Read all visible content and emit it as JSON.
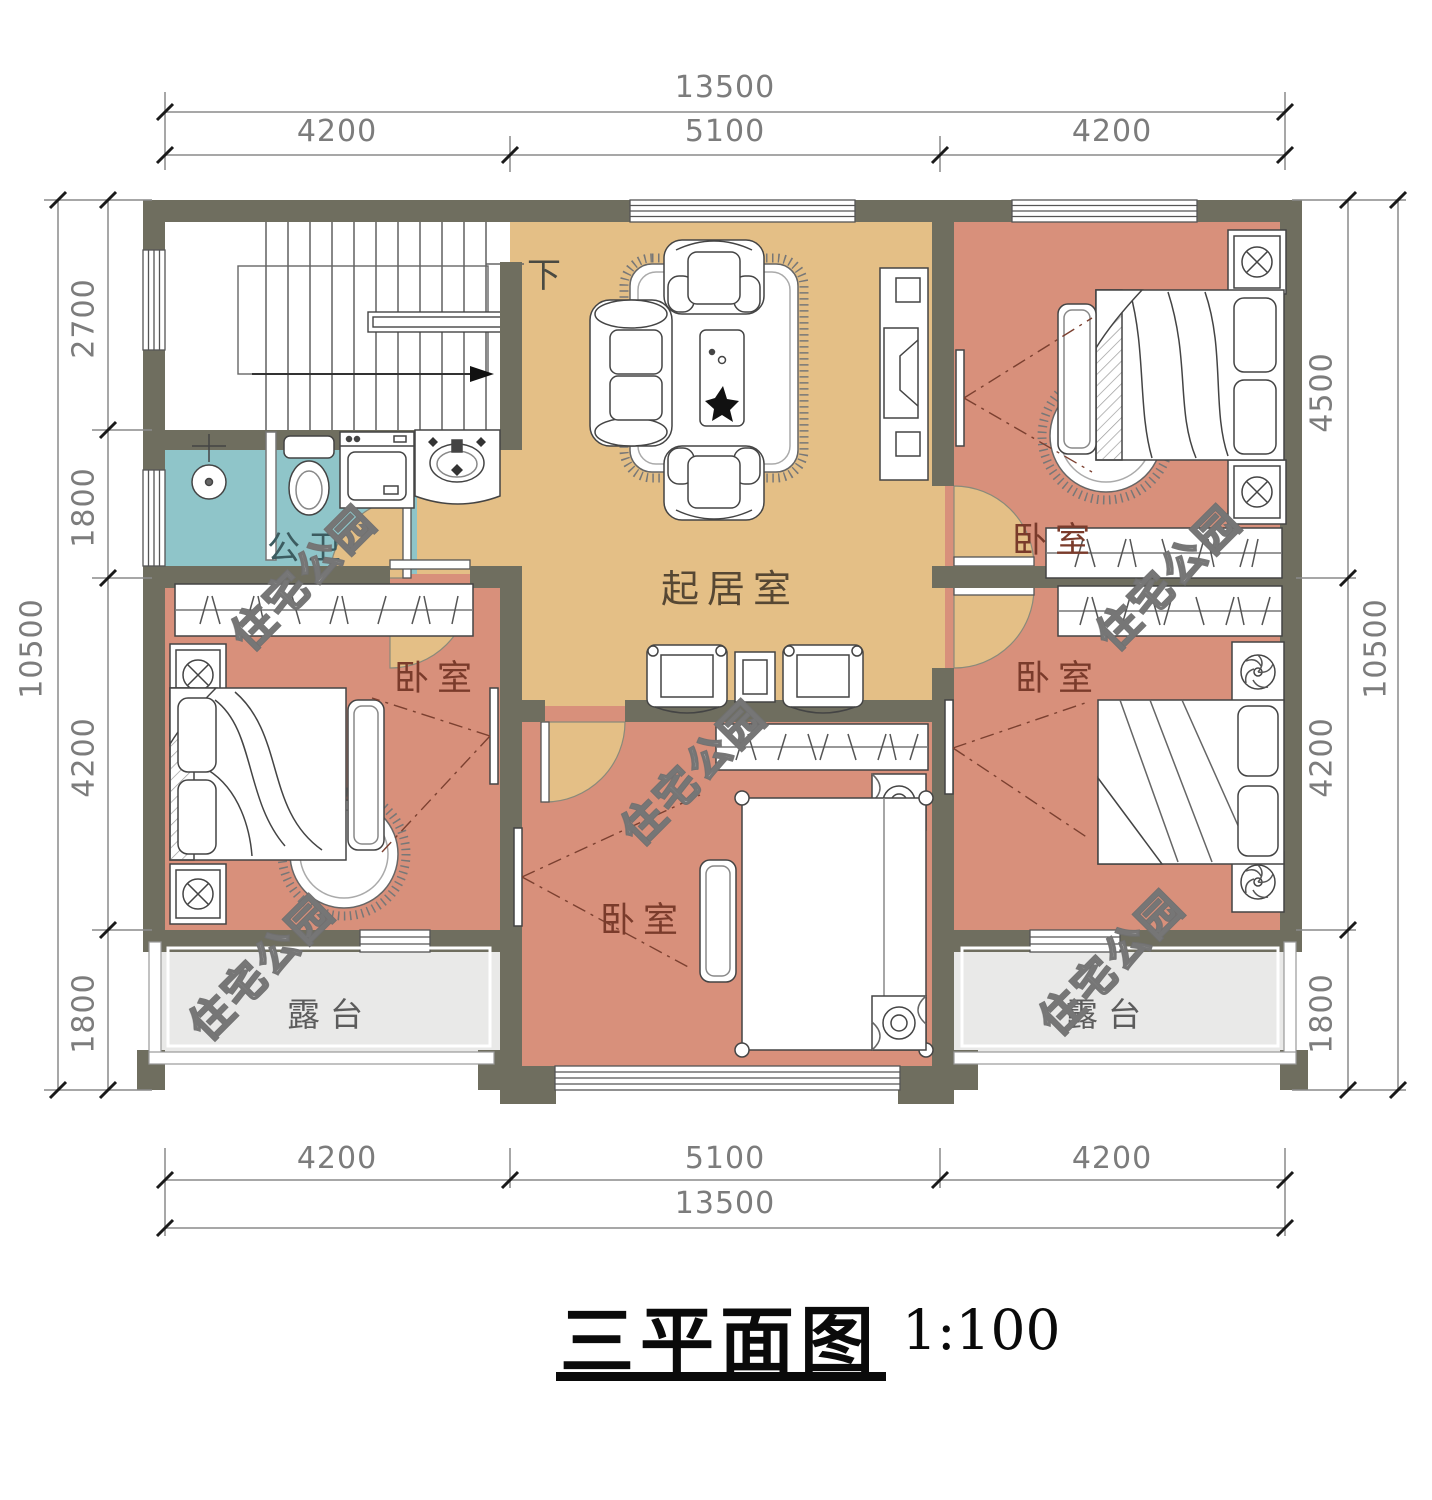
{
  "drawing": {
    "title": "三平面图",
    "scale": "1:100"
  },
  "watermark": {
    "text": "住宅公园"
  },
  "rooms": {
    "living_room": "起居室",
    "bathroom": "公卫",
    "bedroom": "卧室",
    "terrace": "露台",
    "stair_down": "下"
  },
  "dimensions": {
    "top": {
      "overall": "13500",
      "segments": [
        "4200",
        "5100",
        "4200"
      ]
    },
    "bottom": {
      "overall": "13500",
      "segments": [
        "4200",
        "5100",
        "4200"
      ]
    },
    "left": {
      "overall": "10500",
      "segments": [
        "2700",
        "1800",
        "4200",
        "1800"
      ]
    },
    "right": {
      "overall": "10500",
      "segments": [
        "4500",
        "4200",
        "1800"
      ]
    }
  },
  "colors": {
    "wall": "#6f6e5f",
    "living_floor": "#e4bf86",
    "bedroom_floor": "#d8907b",
    "bathroom_floor": "#8fc5c9",
    "terrace_floor": "#e9e9e8",
    "stair_floor": "#ffffff",
    "bedroom_label": "#7a3b2b"
  }
}
